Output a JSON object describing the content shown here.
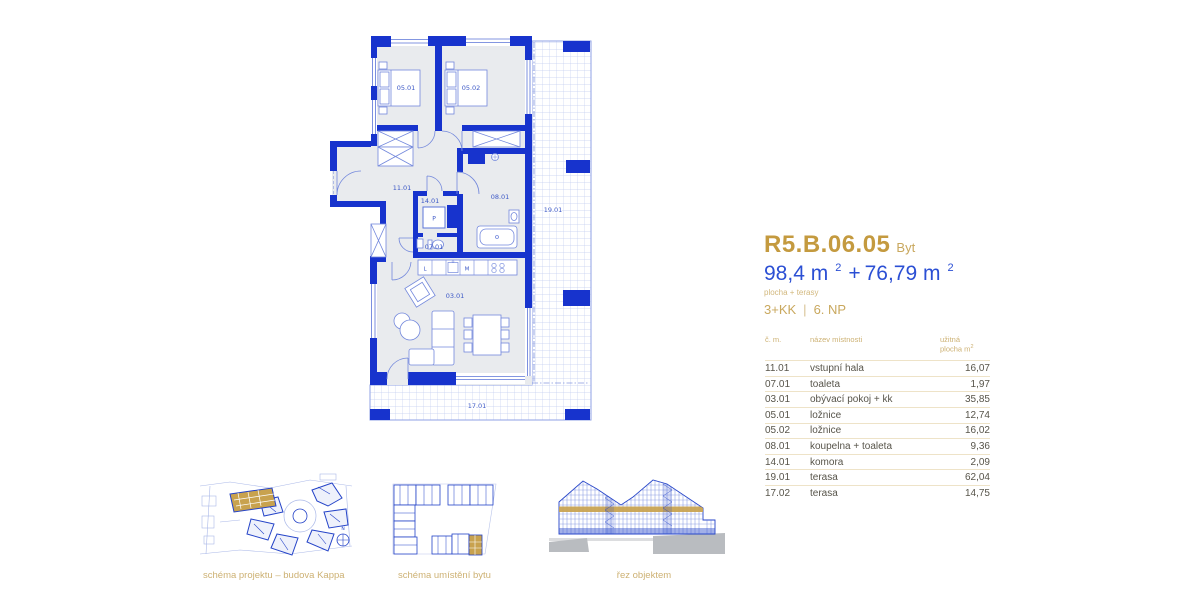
{
  "unit": {
    "code": "R5.B.06.05",
    "type": "Byt",
    "area_main": "98,4 m",
    "area_main_sup": "2",
    "area_plus": "+",
    "area_terrace": "76,79 m",
    "area_terrace_sup": "2",
    "area_note": "plocha + terasy",
    "layout": "3+KK",
    "divider": "|",
    "floor": "6. NP"
  },
  "table": {
    "header": {
      "number": "č. m.",
      "name": "název místnosti",
      "area1": "užitná",
      "area2": "plocha m",
      "area_sup": "2"
    },
    "rows": [
      {
        "number": "11.01",
        "name": "vstupní hala",
        "area": "16,07"
      },
      {
        "number": "07.01",
        "name": "toaleta",
        "area": "1,97"
      },
      {
        "number": "03.01",
        "name": "obývací pokoj + kk",
        "area": "35,85"
      },
      {
        "number": "05.01",
        "name": "ložnice",
        "area": "12,74"
      },
      {
        "number": "05.02",
        "name": "ložnice",
        "area": "16,02"
      },
      {
        "number": "08.01",
        "name": "koupelna + toaleta",
        "area": "9,36"
      },
      {
        "number": "14.01",
        "name": "komora",
        "area": "2,09"
      },
      {
        "number": "19.01",
        "name": "terasa",
        "area": "62,04"
      },
      {
        "number": "17.02",
        "name": "terasa",
        "area": "14,75"
      }
    ]
  },
  "plan": {
    "rooms": {
      "bedroom1": "05.01",
      "bedroom2": "05.02",
      "hall": "11.01",
      "storage": "14.01",
      "toilet": "07.01",
      "bathroom": "08.01",
      "living": "03.01",
      "terrace_right": "19.01",
      "terrace_bottom": "17.01"
    },
    "appliances": {
      "washer": "P",
      "fridge": "L",
      "dishwasher": "M"
    }
  },
  "schematics": {
    "site": {
      "caption": "schéma projektu – budova Kappa",
      "compass": "N"
    },
    "unit_location": {
      "caption": "schéma umístění bytu"
    },
    "section": {
      "caption": "řez objektem"
    }
  },
  "colors": {
    "wall_blue": "#1733cd",
    "accent_gold": "#c49a3f",
    "muted_gold": "#cdb173",
    "area_blue": "#2b4fd4",
    "text_gray": "#57544a"
  }
}
